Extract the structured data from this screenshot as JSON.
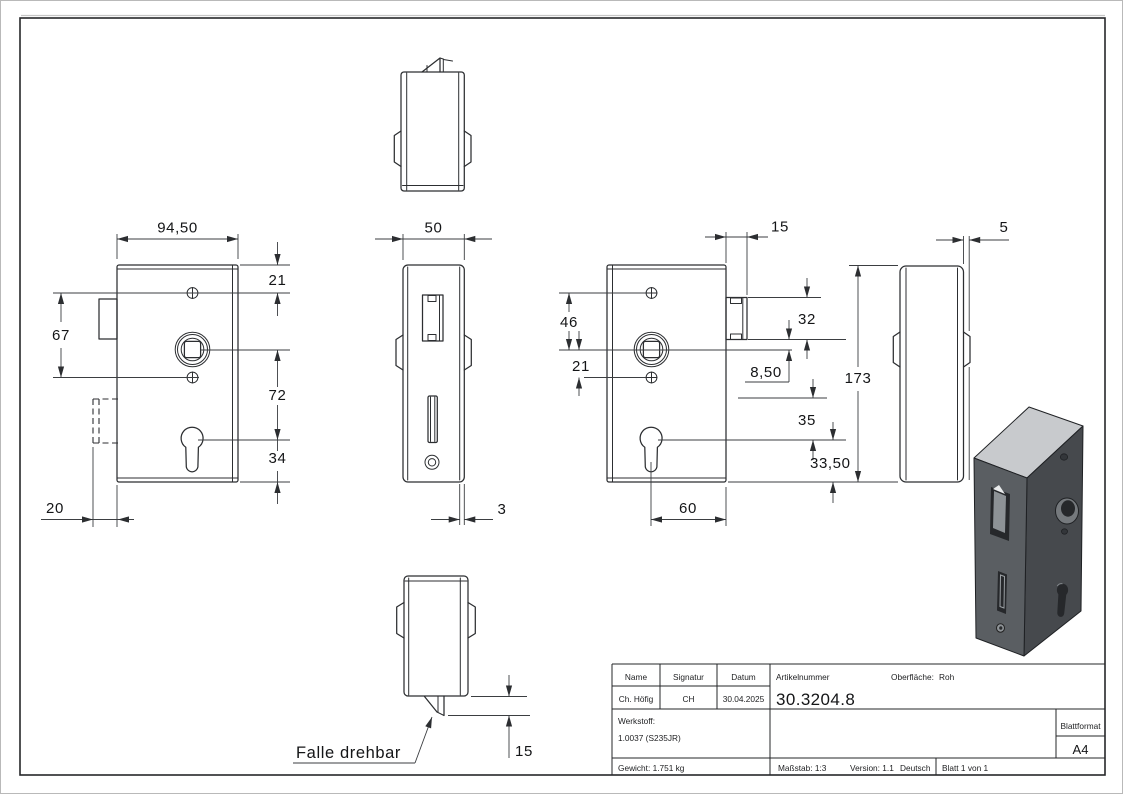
{
  "page": {
    "background": "#ffffff"
  },
  "drawing": {
    "dims": {
      "front_width": "94,50",
      "top_to_screw": "21",
      "screw_spacing": "67",
      "spindle_to_keyhole": "72",
      "keyhole_to_bottom": "34",
      "latch_depth": "20",
      "case_width": "50",
      "cover_thickness": "3",
      "latch_top_width": "15",
      "screw_to_spindle": "46",
      "spindle_to_screw": "21",
      "latch_height": "32",
      "spindle_offset": "8,50",
      "case_height": "173",
      "slot_to_keyhole": "35",
      "keyhole_to_bottom_right": "33,50",
      "keyhole_offset": "60",
      "plate_thickness": "5",
      "latch_bottom_protrusion": "15"
    },
    "notes": {
      "latch_note": "Falle drehbar"
    }
  },
  "title_block": {
    "name_label": "Name",
    "signature_label": "Signatur",
    "date_label": "Datum",
    "article_label": "Artikelnummer",
    "surface_label": "Oberfläche:",
    "surface_value": "Roh",
    "name_value": "Ch. Höfig",
    "signature_value": "CH",
    "date_value": "30.04.2025",
    "article_number": "30.3204.8",
    "material_label": "Werkstoff:",
    "material_value": "1.0037 (S235JR)",
    "sheet_format_label": "Blattformat",
    "sheet_format_value": "A4",
    "weight": "Gewicht: 1.751 kg",
    "scale": "Maßstab: 1:3",
    "version": "Version: 1.1",
    "language": "Deutsch",
    "sheet": "Blatt 1 von 1"
  },
  "colors": {
    "line": "#2c2e31",
    "iso_face_front": "#5a5e62",
    "iso_face_side": "#46494d",
    "iso_face_top": "#c8cacd",
    "iso_latch": "#8d9296",
    "iso_latch_hi": "#e9ebec",
    "iso_hole": "#26282b",
    "iso_collar": "#75797d"
  }
}
